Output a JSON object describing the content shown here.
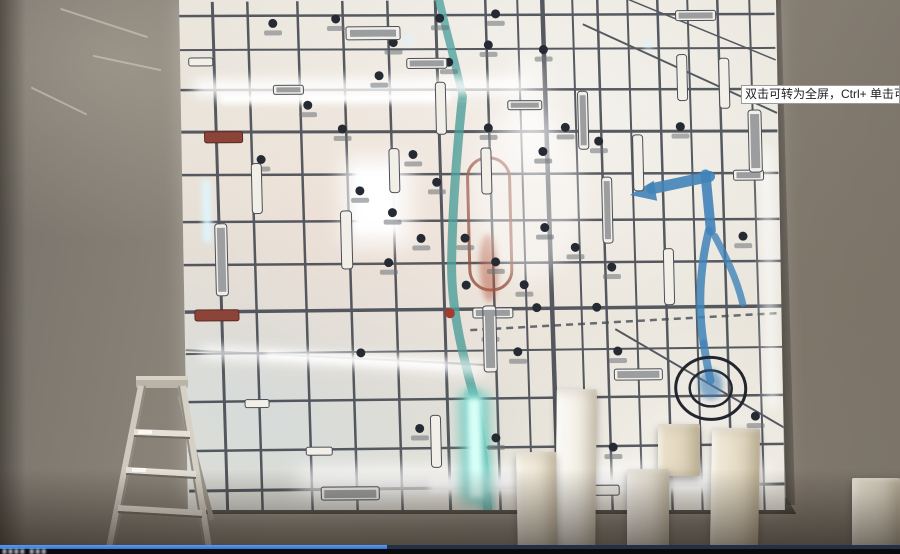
{
  "player": {
    "fullscreen_tooltip": "双击可转为全屏，Ctrl+ 单击可转为",
    "progress_percent": 43,
    "watermark_fragment": "▮▮▮▮ ▮▮▮",
    "colors": {
      "progress_fill": "#2e74d8",
      "progress_track": "#233048",
      "control_bar": "#0a0a0c",
      "tooltip_background": "#ffffff"
    }
  },
  "scene": {
    "colors": {
      "wall": "#8a8478",
      "map_base": "#e9e4da",
      "road": "#3b4049",
      "river_teal": "#4d9e98",
      "river_blue": "#4183b8",
      "glow": "#ffffff",
      "red_accent": "#8d4438"
    }
  }
}
